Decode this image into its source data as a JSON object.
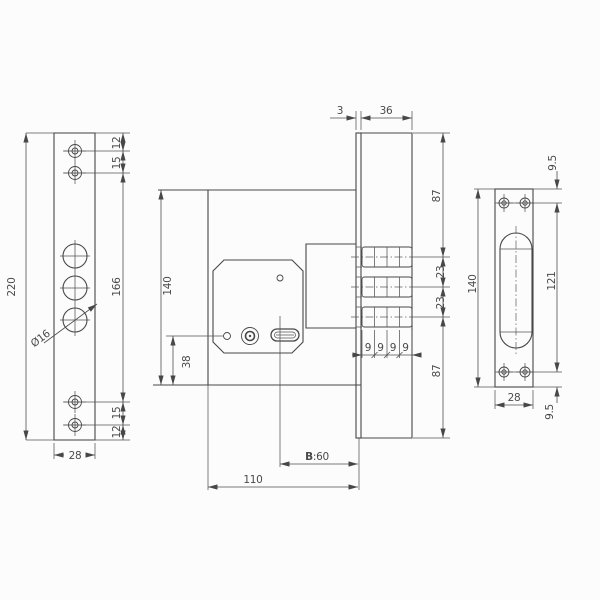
{
  "canvas": {
    "background": "#fcfcfc",
    "line_color": "#474747",
    "text_color": "#4a4a4a"
  },
  "left_view": {
    "overall_height": "220",
    "edge_to_hole_top": "12",
    "screw_hole_spacing_top": "15",
    "screw_hole_span": "166",
    "screw_hole_spacing_bottom": "15",
    "edge_to_hole_bottom": "12",
    "plate_width": "28",
    "bolt_hole_diameter": "Ø16"
  },
  "center_view": {
    "faceplate_thickness": "3",
    "case_depth": "36",
    "body_height": "140",
    "keyhole_axis_to_bottom": "38",
    "backset_prefix": "B",
    "backset_value": ":60",
    "body_length": "110",
    "case_top_to_first_bolt": "87",
    "bolt_pitch_upper": "23",
    "bolt_pitch_lower": "23",
    "last_bolt_to_case_bottom": "87",
    "bolt_steps": [
      "9",
      "9",
      "9",
      "9"
    ]
  },
  "right_view": {
    "edge_to_hole_top": "9.5",
    "hole_span": "121",
    "edge_to_hole_bottom": "9.5",
    "plate_height": "140",
    "plate_width": "28"
  }
}
